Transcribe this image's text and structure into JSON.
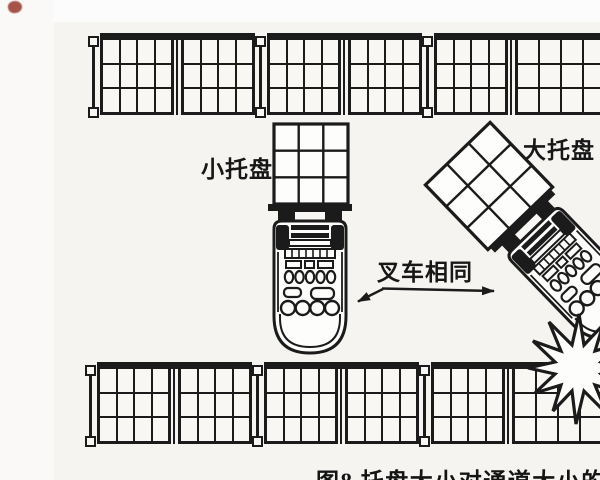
{
  "figure": {
    "caption": "图8 托盘大小对通道大小的影响",
    "labels": {
      "small_pallet": "小托盘",
      "large_pallet": "大托盘",
      "forklifts_same": "叉车相同"
    }
  },
  "diagram": {
    "racks": {
      "rows": [
        {
          "id": "top-rack",
          "pallets": 6,
          "cell_cols": 4,
          "cell_rows": 3
        },
        {
          "id": "bottom-rack",
          "pallets": 6,
          "cell_cols": 4,
          "cell_rows": 3
        }
      ],
      "post_pattern": [
        "feet",
        "thin",
        "feet",
        "thin",
        "feet",
        "thin"
      ]
    },
    "carried_pallets": {
      "small": {
        "cell_cols": 3,
        "cell_rows": 3,
        "orientation_deg": 0
      },
      "large": {
        "cell_cols": 3,
        "cell_rows": 3,
        "orientation_deg": -44
      }
    },
    "forklift_count": 2,
    "icons": [
      "collision-burst-icon",
      "scan-artifact-mark",
      "callout-arrow-icon"
    ],
    "colors": {
      "ink": "#1b1b1b",
      "paper": "#f5f4f1",
      "page_top": "#fcfcfc",
      "artifact_red": "#9e4238"
    }
  }
}
